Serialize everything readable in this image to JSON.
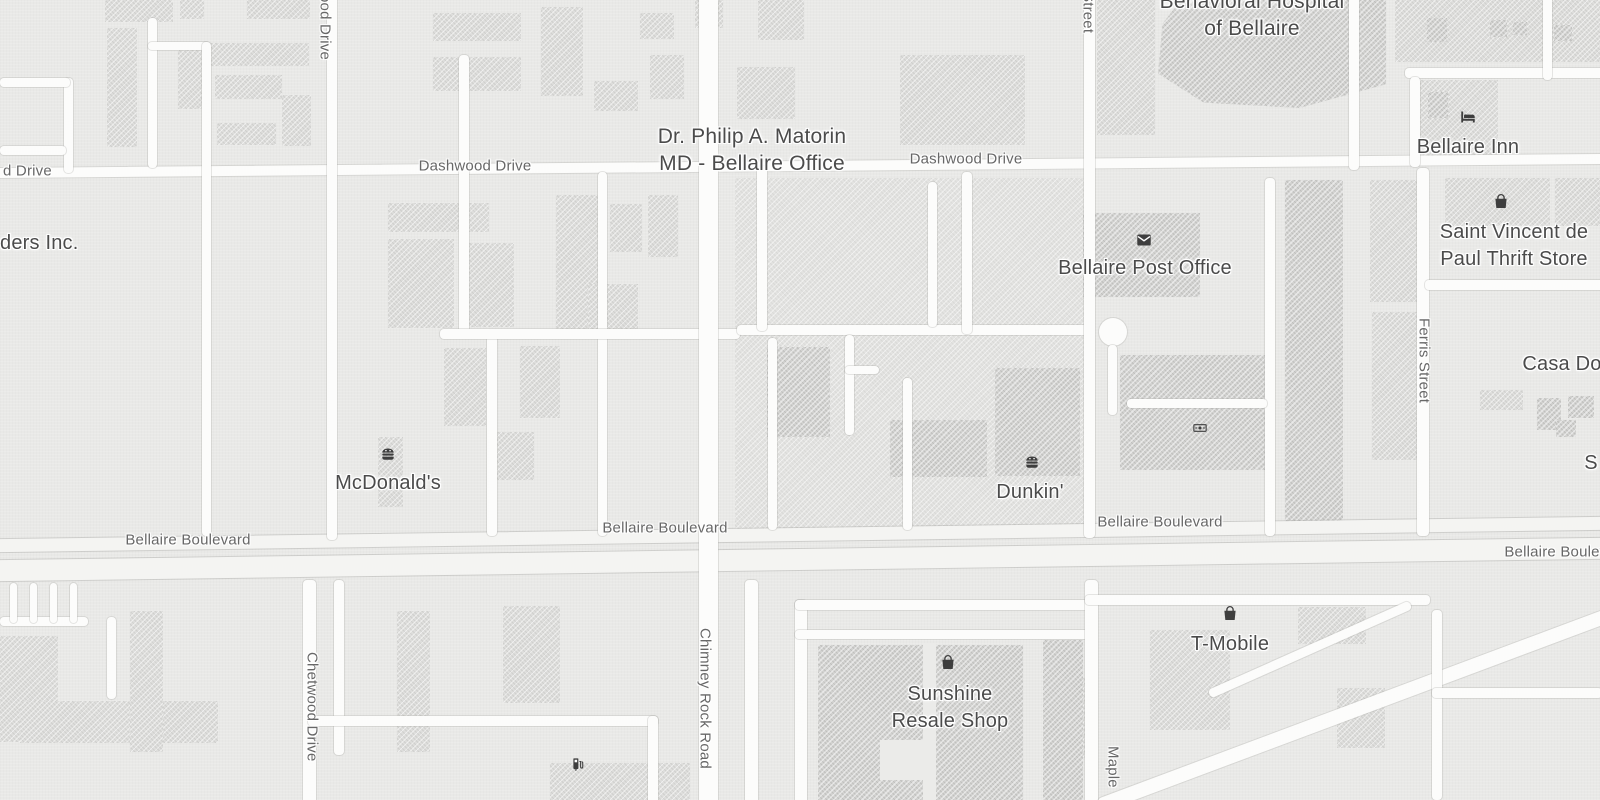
{
  "map": {
    "background": "#e9e9e7",
    "road_fill": "#fcfcfb",
    "major_road_fill": "#f4f4f2",
    "building_fill": "#dededc",
    "building_dark_fill": "#d2d2d0",
    "road_label_color": "#676767",
    "poi_label_color": "#4b4b4b",
    "icon_color": "#3e3e3e"
  },
  "road_labels": [
    {
      "text": "d Drive",
      "x": 3,
      "y": 171,
      "align": "left"
    },
    {
      "text": "Dashwood Drive",
      "x": 475,
      "y": 166
    },
    {
      "text": "Dashwood Drive",
      "x": 966,
      "y": 159
    },
    {
      "text": "Bellaire Boulevard",
      "x": 188,
      "y": 540
    },
    {
      "text": "Bellaire Boulevard",
      "x": 665,
      "y": 528
    },
    {
      "text": "Bellaire Boulevard",
      "x": 1160,
      "y": 522
    },
    {
      "text": "Bellaire Boulevard",
      "x": 1567,
      "y": 552
    },
    {
      "text": "ood Drive",
      "x": 325,
      "y": -6,
      "vertical": true
    },
    {
      "text": "Street",
      "x": 1088,
      "y": -8,
      "vertical": true
    },
    {
      "text": "Ferris Street",
      "x": 1424,
      "y": 318,
      "vertical": true
    },
    {
      "text": "Chetwood Drive",
      "x": 312,
      "y": 652,
      "vertical": true
    },
    {
      "text": "Chimney Rock Road",
      "x": 705,
      "y": 628,
      "vertical": true
    },
    {
      "text": "Maple",
      "x": 1113,
      "y": 746,
      "vertical": true
    }
  ],
  "poi_labels": [
    {
      "name": "poi-dr-philip-matorin",
      "lines": [
        "Dr. Philip A. Matorin",
        "MD - Bellaire Office"
      ],
      "x": 752,
      "y": 136,
      "size": 21
    },
    {
      "name": "poi-behavioral-hospital",
      "lines": [
        "Behavioral Hospital",
        "of Bellaire"
      ],
      "x": 1252,
      "y": 1,
      "size": 21
    },
    {
      "name": "poi-bellaire-post-office",
      "icon": "mail-icon",
      "icon_pos": [
        1144,
        240
      ],
      "lines": [
        "Bellaire Post Office"
      ],
      "x": 1145,
      "y": 268
    },
    {
      "name": "poi-bellaire-inn",
      "icon": "bed-icon",
      "icon_pos": [
        1468,
        117
      ],
      "lines": [
        "Bellaire Inn"
      ],
      "x": 1468,
      "y": 147
    },
    {
      "name": "poi-saint-vincent-thrift",
      "icon": "bag-icon",
      "icon_pos": [
        1501,
        201
      ],
      "lines": [
        "Saint Vincent de",
        "Paul Thrift Store"
      ],
      "x": 1514,
      "y": 232
    },
    {
      "name": "poi-mcdonalds",
      "icon": "burger-icon",
      "icon_pos": [
        388,
        454
      ],
      "lines": [
        "McDonald's"
      ],
      "x": 388,
      "y": 483
    },
    {
      "name": "poi-dunkin",
      "icon": "burger-icon",
      "icon_pos": [
        1032,
        462
      ],
      "lines": [
        "Dunkin'"
      ],
      "x": 1030,
      "y": 492
    },
    {
      "name": "poi-sunshine-resale",
      "icon": "bag-icon",
      "icon_pos": [
        948,
        662
      ],
      "lines": [
        "Sunshine",
        "Resale Shop"
      ],
      "x": 950,
      "y": 694
    },
    {
      "name": "poi-t-mobile",
      "icon": "bag-icon",
      "icon_pos": [
        1230,
        613
      ],
      "lines": [
        "T-Mobile"
      ],
      "x": 1230,
      "y": 644
    },
    {
      "name": "poi-casa-do",
      "lines": [
        "Casa Do"
      ],
      "x": 1562,
      "y": 364
    },
    {
      "name": "poi-ders-inc",
      "lines": [
        "ders Inc."
      ],
      "x": 0,
      "y": 243,
      "align": "left"
    },
    {
      "name": "poi-s-partial",
      "lines": [
        "S"
      ],
      "x": 1591,
      "y": 463
    },
    {
      "name": "poi-atm",
      "icon": "banknote-icon",
      "icon_pos": [
        1200,
        428
      ],
      "icon_size": 16
    },
    {
      "name": "poi-fuel",
      "icon": "fuel-icon",
      "icon_pos": [
        578,
        764
      ],
      "icon_size": 17
    }
  ],
  "roads": [
    {
      "x": -10,
      "y": 161,
      "w": 1620,
      "h": 10,
      "rot": -0.5,
      "name": "dashwood-drive-road"
    },
    {
      "x": -10,
      "y": 528,
      "w": 1620,
      "h": 13,
      "rot": -0.8,
      "major": true,
      "name": "bellaire-boulevard-upper-road"
    },
    {
      "x": -10,
      "y": 549,
      "w": 1620,
      "h": 21,
      "rot": -0.8,
      "major": true,
      "name": "bellaire-boulevard-lower-road"
    },
    {
      "x": 64,
      "y": 78,
      "w": 9,
      "h": 95
    },
    {
      "x": 0,
      "y": 78,
      "w": 70,
      "h": 9
    },
    {
      "x": 0,
      "y": 146,
      "w": 66,
      "h": 9
    },
    {
      "x": 148,
      "y": 18,
      "w": 9,
      "h": 150
    },
    {
      "x": 148,
      "y": 42,
      "w": 62,
      "h": 8
    },
    {
      "x": 202,
      "y": 42,
      "w": 9,
      "h": 494
    },
    {
      "x": 327,
      "y": -10,
      "w": 10,
      "h": 550
    },
    {
      "x": 459,
      "y": 55,
      "w": 10,
      "h": 282
    },
    {
      "x": 487,
      "y": 330,
      "w": 10,
      "h": 206
    },
    {
      "x": 598,
      "y": 172,
      "w": 9,
      "h": 364
    },
    {
      "x": 440,
      "y": 329,
      "w": 300,
      "h": 10
    },
    {
      "x": 737,
      "y": 325,
      "w": 352,
      "h": 10
    },
    {
      "x": 699,
      "y": -10,
      "w": 19,
      "h": 820,
      "name": "chimney-rock-road"
    },
    {
      "x": 757,
      "y": 166,
      "w": 10,
      "h": 165
    },
    {
      "x": 962,
      "y": 172,
      "w": 10,
      "h": 162
    },
    {
      "x": 1084,
      "y": -10,
      "w": 11,
      "h": 548,
      "name": "street-north-road"
    },
    {
      "x": 1265,
      "y": 178,
      "w": 10,
      "h": 358
    },
    {
      "x": 1417,
      "y": 168,
      "w": 12,
      "h": 368,
      "name": "ferris-street-road"
    },
    {
      "x": 1425,
      "y": 280,
      "w": 180,
      "h": 10
    },
    {
      "x": 1349,
      "y": -10,
      "w": 10,
      "h": 180
    },
    {
      "x": 1405,
      "y": 68,
      "w": 200,
      "h": 10
    },
    {
      "x": 1410,
      "y": 77,
      "w": 10,
      "h": 90
    },
    {
      "x": 1543,
      "y": -10,
      "w": 9,
      "h": 90
    },
    {
      "x": 0,
      "y": 617,
      "w": 88,
      "h": 9
    },
    {
      "x": 10,
      "y": 583,
      "w": 7,
      "h": 40
    },
    {
      "x": 30,
      "y": 583,
      "w": 7,
      "h": 40
    },
    {
      "x": 50,
      "y": 583,
      "w": 7,
      "h": 40
    },
    {
      "x": 70,
      "y": 583,
      "w": 7,
      "h": 40
    },
    {
      "x": 107,
      "y": 617,
      "w": 9,
      "h": 82
    },
    {
      "x": 303,
      "y": 580,
      "w": 13,
      "h": 230,
      "name": "chetwood-drive-road"
    },
    {
      "x": 334,
      "y": 580,
      "w": 10,
      "h": 175
    },
    {
      "x": 308,
      "y": 716,
      "w": 350,
      "h": 10
    },
    {
      "x": 648,
      "y": 716,
      "w": 10,
      "h": 90
    },
    {
      "x": 745,
      "y": 580,
      "w": 13,
      "h": 226
    },
    {
      "x": 795,
      "y": 600,
      "w": 12,
      "h": 204
    },
    {
      "x": 795,
      "y": 600,
      "w": 295,
      "h": 10
    },
    {
      "x": 795,
      "y": 630,
      "w": 295,
      "h": 9
    },
    {
      "x": 1085,
      "y": 580,
      "w": 13,
      "h": 226,
      "name": "maple-street-road"
    },
    {
      "x": 1085,
      "y": 595,
      "w": 345,
      "h": 10
    },
    {
      "x": 1080,
      "y": 690,
      "w": 620,
      "h": 14,
      "rot": -20.5
    },
    {
      "x": 1200,
      "y": 645,
      "w": 220,
      "h": 9,
      "rot": -24
    },
    {
      "x": 1432,
      "y": 610,
      "w": 10,
      "h": 190
    },
    {
      "x": 1432,
      "y": 688,
      "w": 170,
      "h": 10
    },
    {
      "x": 768,
      "y": 338,
      "w": 9,
      "h": 192
    },
    {
      "x": 845,
      "y": 335,
      "w": 9,
      "h": 100
    },
    {
      "x": 845,
      "y": 366,
      "w": 34,
      "h": 8
    },
    {
      "x": 903,
      "y": 378,
      "w": 9,
      "h": 152
    },
    {
      "x": 928,
      "y": 182,
      "w": 9,
      "h": 145
    },
    {
      "x": 1099,
      "y": 318,
      "w": 28,
      "h": 28,
      "circle": true
    },
    {
      "x": 1108,
      "y": 345,
      "w": 9,
      "h": 70
    },
    {
      "x": 1127,
      "y": 399,
      "w": 140,
      "h": 9
    }
  ],
  "buildings": [
    {
      "x": 735,
      "y": 178,
      "w": 356,
      "h": 352,
      "v": "base"
    },
    {
      "x": 105,
      "y": 0,
      "w": 68,
      "h": 22,
      "v": "l"
    },
    {
      "x": 180,
      "y": 0,
      "w": 24,
      "h": 19,
      "v": "l"
    },
    {
      "x": 247,
      "y": 0,
      "w": 63,
      "h": 19,
      "v": "l"
    },
    {
      "x": 107,
      "y": 28,
      "w": 30,
      "h": 119,
      "v": "l"
    },
    {
      "x": 178,
      "y": 50,
      "w": 24,
      "h": 59,
      "v": "l"
    },
    {
      "x": 208,
      "y": 43,
      "w": 101,
      "h": 23,
      "v": "l"
    },
    {
      "x": 215,
      "y": 75,
      "w": 67,
      "h": 24,
      "v": "l"
    },
    {
      "x": 282,
      "y": 95,
      "w": 29,
      "h": 51,
      "v": "l"
    },
    {
      "x": 217,
      "y": 123,
      "w": 59,
      "h": 22,
      "v": "l"
    },
    {
      "x": 433,
      "y": 13,
      "w": 88,
      "h": 28,
      "v": "l"
    },
    {
      "x": 433,
      "y": 57,
      "w": 88,
      "h": 34,
      "v": "l"
    },
    {
      "x": 541,
      "y": 7,
      "w": 42,
      "h": 89,
      "v": "l"
    },
    {
      "x": 594,
      "y": 81,
      "w": 44,
      "h": 30,
      "v": "l"
    },
    {
      "x": 640,
      "y": 13,
      "w": 34,
      "h": 26,
      "v": "l"
    },
    {
      "x": 650,
      "y": 55,
      "w": 34,
      "h": 44,
      "v": "l"
    },
    {
      "x": 695,
      "y": 0,
      "w": 28,
      "h": 28,
      "v": "l"
    },
    {
      "x": 737,
      "y": 67,
      "w": 58,
      "h": 52,
      "v": "l"
    },
    {
      "x": 758,
      "y": 0,
      "w": 46,
      "h": 40,
      "v": "l"
    },
    {
      "x": 900,
      "y": 55,
      "w": 125,
      "h": 90,
      "v": "l"
    },
    {
      "x": 388,
      "y": 203,
      "w": 101,
      "h": 29,
      "v": "l"
    },
    {
      "x": 388,
      "y": 239,
      "w": 66,
      "h": 89,
      "v": "l"
    },
    {
      "x": 468,
      "y": 243,
      "w": 46,
      "h": 84,
      "v": "l"
    },
    {
      "x": 556,
      "y": 195,
      "w": 44,
      "h": 136,
      "v": "l"
    },
    {
      "x": 610,
      "y": 204,
      "w": 32,
      "h": 48,
      "v": "l"
    },
    {
      "x": 648,
      "y": 195,
      "w": 30,
      "h": 62,
      "v": "l"
    },
    {
      "x": 588,
      "y": 284,
      "w": 50,
      "h": 45,
      "v": "l"
    },
    {
      "x": 444,
      "y": 348,
      "w": 42,
      "h": 78,
      "v": "l"
    },
    {
      "x": 520,
      "y": 346,
      "w": 40,
      "h": 72,
      "v": "l"
    },
    {
      "x": 490,
      "y": 432,
      "w": 44,
      "h": 48,
      "v": "l"
    },
    {
      "x": 378,
      "y": 437,
      "w": 25,
      "h": 70,
      "v": "l"
    },
    {
      "x": 1097,
      "y": 0,
      "w": 58,
      "h": 135,
      "v": "l"
    },
    {
      "x": 1395,
      "y": 0,
      "w": 205,
      "h": 62,
      "v": "l"
    },
    {
      "x": 1420,
      "y": 80,
      "w": 78,
      "h": 80,
      "v": "l"
    },
    {
      "x": 1445,
      "y": 178,
      "w": 105,
      "h": 48,
      "v": "l"
    },
    {
      "x": 1555,
      "y": 178,
      "w": 45,
      "h": 48,
      "v": "l"
    },
    {
      "x": 1370,
      "y": 180,
      "w": 48,
      "h": 122,
      "v": "l"
    },
    {
      "x": 1372,
      "y": 312,
      "w": 48,
      "h": 148,
      "v": "l"
    },
    {
      "x": 1480,
      "y": 390,
      "w": 43,
      "h": 20,
      "v": "l"
    },
    {
      "x": 0,
      "y": 636,
      "w": 58,
      "h": 106,
      "v": "l"
    },
    {
      "x": 20,
      "y": 701,
      "w": 198,
      "h": 42,
      "v": "l"
    },
    {
      "x": 130,
      "y": 611,
      "w": 33,
      "h": 141,
      "v": "l"
    },
    {
      "x": 397,
      "y": 611,
      "w": 33,
      "h": 141,
      "v": "l"
    },
    {
      "x": 503,
      "y": 606,
      "w": 57,
      "h": 97,
      "v": "l"
    },
    {
      "x": 550,
      "y": 763,
      "w": 140,
      "h": 37,
      "v": "l"
    },
    {
      "x": 1150,
      "y": 630,
      "w": 80,
      "h": 100,
      "v": "l"
    },
    {
      "x": 1298,
      "y": 607,
      "w": 68,
      "h": 37,
      "v": "l"
    },
    {
      "x": 1337,
      "y": 688,
      "w": 48,
      "h": 60,
      "v": "l"
    },
    {
      "x": 1048,
      "y": 678,
      "w": 42,
      "h": 80,
      "v": "l"
    },
    {
      "x": 767,
      "y": 347,
      "w": 63,
      "h": 90,
      "v": "d"
    },
    {
      "x": 890,
      "y": 420,
      "w": 97,
      "h": 57,
      "v": "d"
    },
    {
      "x": 995,
      "y": 368,
      "w": 85,
      "h": 108,
      "v": "d"
    },
    {
      "x": 1083,
      "y": 213,
      "w": 117,
      "h": 84,
      "v": "d"
    },
    {
      "x": 1120,
      "y": 355,
      "w": 148,
      "h": 115,
      "v": "d"
    },
    {
      "x": 1285,
      "y": 180,
      "w": 58,
      "h": 348,
      "v": "d"
    },
    {
      "x": 1158,
      "y": 0,
      "w": 228,
      "h": 108,
      "v": "d",
      "name": "hospital-building",
      "clip": "polygon(10% 0, 100% 0, 100% 78%, 62% 100%, 20% 95%, 0 68%, 2% 22%)"
    },
    {
      "x": 1427,
      "y": 18,
      "w": 20,
      "h": 24,
      "v": "d"
    },
    {
      "x": 1490,
      "y": 20,
      "w": 17,
      "h": 17,
      "v": "d"
    },
    {
      "x": 1513,
      "y": 22,
      "w": 14,
      "h": 13,
      "v": "d"
    },
    {
      "x": 1554,
      "y": 25,
      "w": 18,
      "h": 16,
      "v": "d"
    },
    {
      "x": 1428,
      "y": 92,
      "w": 20,
      "h": 26,
      "v": "d"
    },
    {
      "x": 1537,
      "y": 398,
      "w": 24,
      "h": 32,
      "v": "d"
    },
    {
      "x": 1568,
      "y": 396,
      "w": 26,
      "h": 22,
      "v": "d"
    },
    {
      "x": 1556,
      "y": 420,
      "w": 20,
      "h": 17,
      "v": "d"
    },
    {
      "x": 818,
      "y": 645,
      "w": 105,
      "h": 155,
      "v": "d"
    },
    {
      "x": 936,
      "y": 645,
      "w": 87,
      "h": 155,
      "v": "d"
    },
    {
      "x": 1043,
      "y": 640,
      "w": 40,
      "h": 160,
      "v": "d"
    },
    {
      "x": 923,
      "y": 643,
      "w": 13,
      "h": 157,
      "v": "w"
    },
    {
      "x": 880,
      "y": 740,
      "w": 45,
      "h": 40,
      "v": "w"
    }
  ]
}
